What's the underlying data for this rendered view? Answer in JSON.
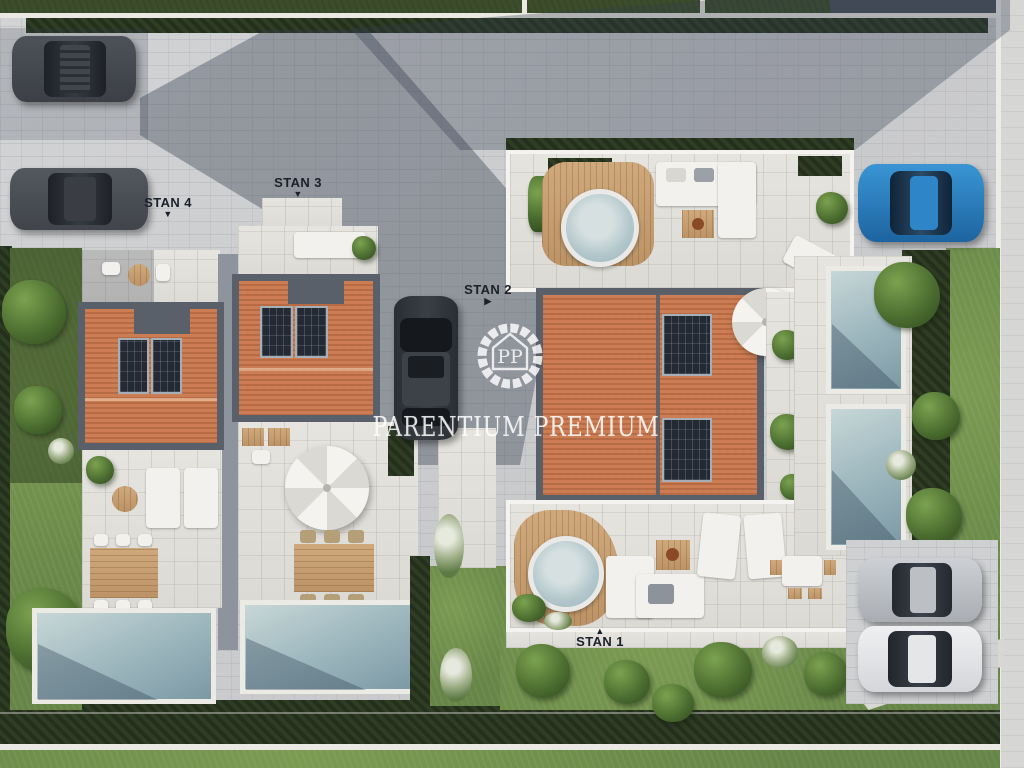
{
  "watermark": {
    "monogram": "PP",
    "text": "PARENTIUM PREMIUM"
  },
  "units": [
    {
      "id": "stan-1",
      "label": "STAN 1",
      "arrow": "▲"
    },
    {
      "id": "stan-2",
      "label": "STAN 2",
      "arrow": "▶"
    },
    {
      "id": "stan-3",
      "label": "STAN 3",
      "arrow": "▼"
    },
    {
      "id": "stan-4",
      "label": "STAN 4",
      "arrow": "▼"
    }
  ],
  "colors": {
    "roof_terracotta": "#c27449",
    "pool_water": "#8fa9b0",
    "lawn_green": "#67874a",
    "pavement_gray": "#cdced0",
    "car_blue": "#2e86c8",
    "label_text": "#1b212b",
    "watermark_white": "#ffffff"
  }
}
